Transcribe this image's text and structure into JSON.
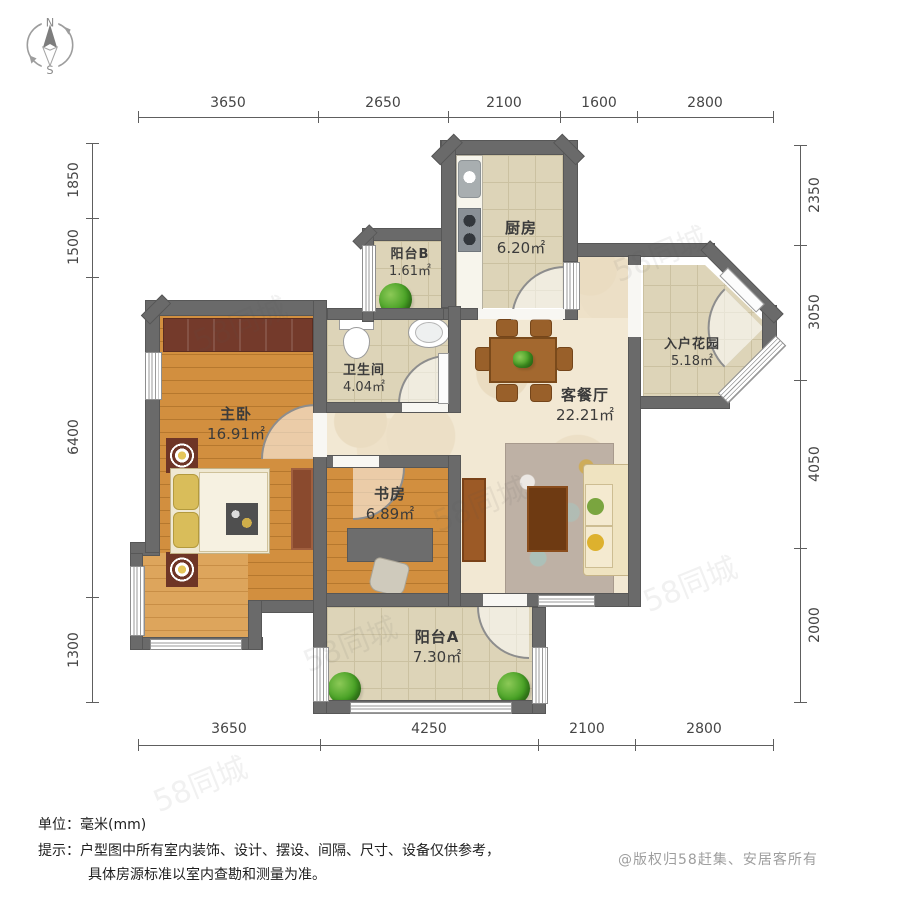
{
  "compass": {
    "north": "N",
    "south": "S"
  },
  "watermark": {
    "text": "58同城"
  },
  "rooms": [
    {
      "name": "主卧",
      "area": "16.91㎡"
    },
    {
      "name": "书房",
      "area": "6.89㎡"
    },
    {
      "name": "卫生间",
      "area": "4.04㎡"
    },
    {
      "name": "厨房",
      "area": "6.20㎡"
    },
    {
      "name": "阳台B",
      "area": "1.61㎡"
    },
    {
      "name": "客餐厅",
      "area": "22.21㎡"
    },
    {
      "name": "入户花园",
      "area": "5.18㎡"
    },
    {
      "name": "阳台A",
      "area": "7.30㎡"
    }
  ],
  "dimensions": {
    "top": [
      "3650",
      "2650",
      "2100",
      "1600",
      "2800"
    ],
    "bottom": [
      "3650",
      "4250",
      "2100",
      "2800"
    ],
    "left": [
      "1850",
      "1500",
      "6400",
      "1300"
    ],
    "right": [
      "2350",
      "3050",
      "4050",
      "2000"
    ]
  },
  "footer": {
    "unit_line": "单位：毫米(mm)",
    "tip_label": "提示：",
    "tip_line1": "户型图中所有室内装饰、设计、摆设、间隔、尺寸、设备仅供参考，",
    "tip_line2": "具体房源标准以室内查勘和测量为准。",
    "copyright": "@版权归58赶集、安居客所有"
  },
  "colors": {
    "wall": "#6a6a6a",
    "wood_floor": "#d28f3f",
    "bay_wood_floor": "#dda55c",
    "tile_floor": "#ddd4b8",
    "living_floor": "#f2e8d3",
    "wardrobe_brown": "#743a2b",
    "furniture_brown": "#a3682f",
    "coffee_table_brown": "#6e3a12",
    "plant_green": "#46a024",
    "sofa_cream": "#efe3c0"
  }
}
